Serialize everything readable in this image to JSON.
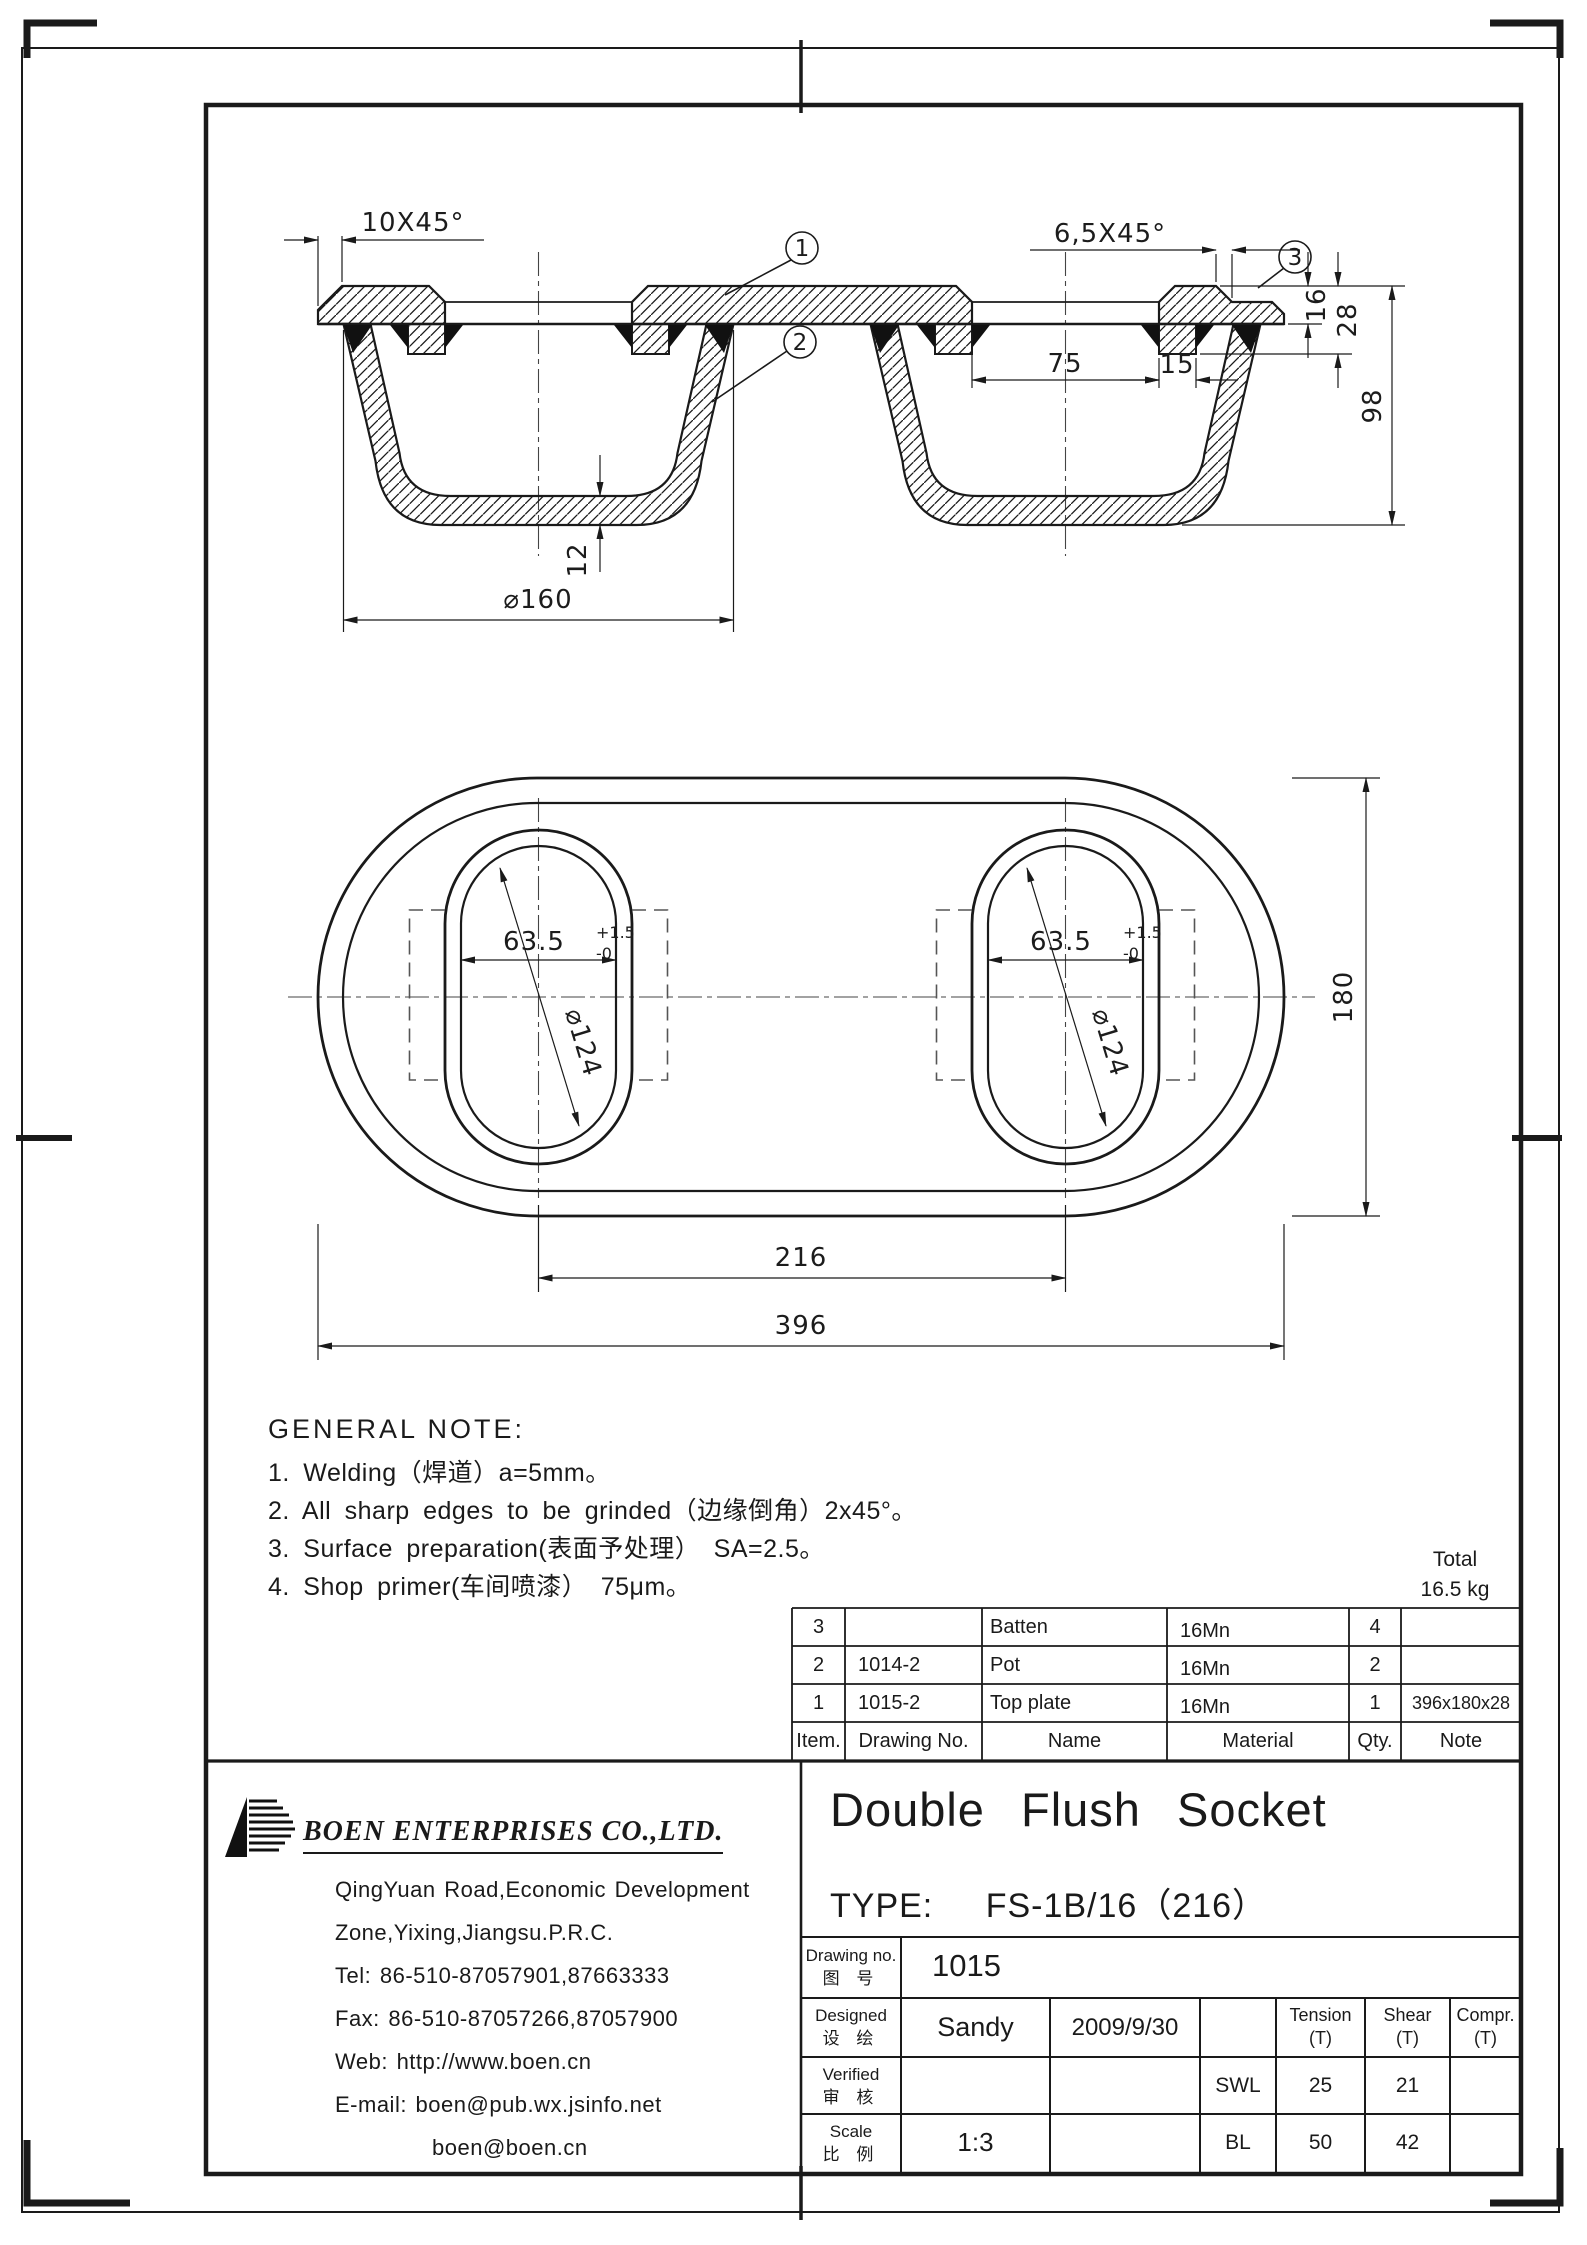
{
  "callouts": {
    "one": "1",
    "two": "2",
    "three": "3"
  },
  "dims": {
    "chamfer_left": "10X45°",
    "chamfer_right": "6,5X45°",
    "pitch75": "75",
    "batten15": "15",
    "t16": "16",
    "t28": "28",
    "h98": "98",
    "bottom12": "12",
    "mouth160": "⌀160",
    "slot_width": "63.5",
    "slot_tol_plus": "+1.5",
    "slot_tol_minus": "-0",
    "pot_dia": "⌀124",
    "centers216": "216",
    "length396": "396",
    "width180": "180"
  },
  "notes": {
    "title": "GENERAL NOTE:",
    "item1": "1. Welding（焊道）a=5mm。",
    "item2": "2. All sharp edges to be grinded（边缘倒角）2x45°。",
    "item3": "3. Surface preparation(表面予处理） SA=2.5。",
    "item4": "4. Shop primer(车间喷漆） 75μm。"
  },
  "total": {
    "label": "Total",
    "value": "16.5 kg"
  },
  "parts_table": {
    "headers": [
      "Item.",
      "Drawing No.",
      "Name",
      "Material",
      "Qty.",
      "Note"
    ],
    "rows": [
      [
        "3",
        "",
        "Batten",
        "16Mn",
        "4",
        ""
      ],
      [
        "2",
        "1014-2",
        "Pot",
        "16Mn",
        "2",
        ""
      ],
      [
        "1",
        "1015-2",
        "Top plate",
        "16Mn",
        "1",
        "396x180x28"
      ]
    ]
  },
  "title_block": {
    "product_title": "Double Flush Socket",
    "type_label": "TYPE:",
    "type_value": "FS-1B/16（216）",
    "drawing_no_en": "Drawing no.",
    "drawing_no_cn": "图 号",
    "drawing_no": "1015",
    "designed_en": "Designed",
    "designed_cn": "设 绘",
    "designer": "Sandy",
    "date": "2009/9/30",
    "verified_en": "Verified",
    "verified_cn": "审 核",
    "scale_en": "Scale",
    "scale_cn": "比 例",
    "scale": "1:3",
    "tension": "Tension",
    "shear": "Shear",
    "compr": "Compr.",
    "t_unit": "(T)",
    "swl": "SWL",
    "bl": "BL",
    "swl_tension": "25",
    "swl_shear": "21",
    "bl_tension": "50",
    "bl_shear": "42"
  },
  "company": {
    "name": "BOEN ENTERPRISES CO.,LTD.",
    "address1": "QingYuan Road,Economic Development",
    "address2": "Zone,Yixing,Jiangsu.P.R.C.",
    "tel": "Tel: 86-510-87057901,87663333",
    "fax": "Fax: 86-510-87057266,87057900",
    "web": "Web: http://www.boen.cn",
    "email": "E-mail: boen@pub.wx.jsinfo.net",
    "email2": "boen@boen.cn"
  }
}
